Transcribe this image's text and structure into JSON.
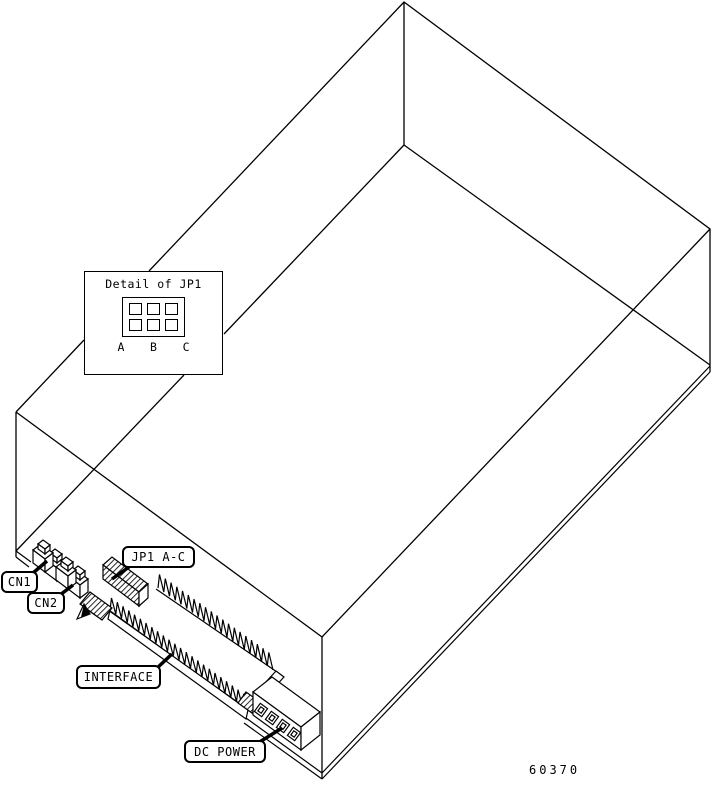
{
  "figure": {
    "number": "60370",
    "background_color": "#ffffff",
    "line_color": "#000000",
    "description": "Isometric line drawing of a disk drive chassis showing rear connector locations"
  },
  "detail_inset": {
    "title": "Detail of JP1",
    "pin_labels": [
      "A",
      "B",
      "C"
    ],
    "grid_rows": 2,
    "grid_cols": 3
  },
  "callouts": {
    "cn1": {
      "label": "CN1"
    },
    "cn2": {
      "label": "CN2"
    },
    "jp1": {
      "label": "JP1 A-C"
    },
    "interface": {
      "label": "INTERFACE"
    },
    "dc_power": {
      "label": "DC POWER"
    }
  }
}
